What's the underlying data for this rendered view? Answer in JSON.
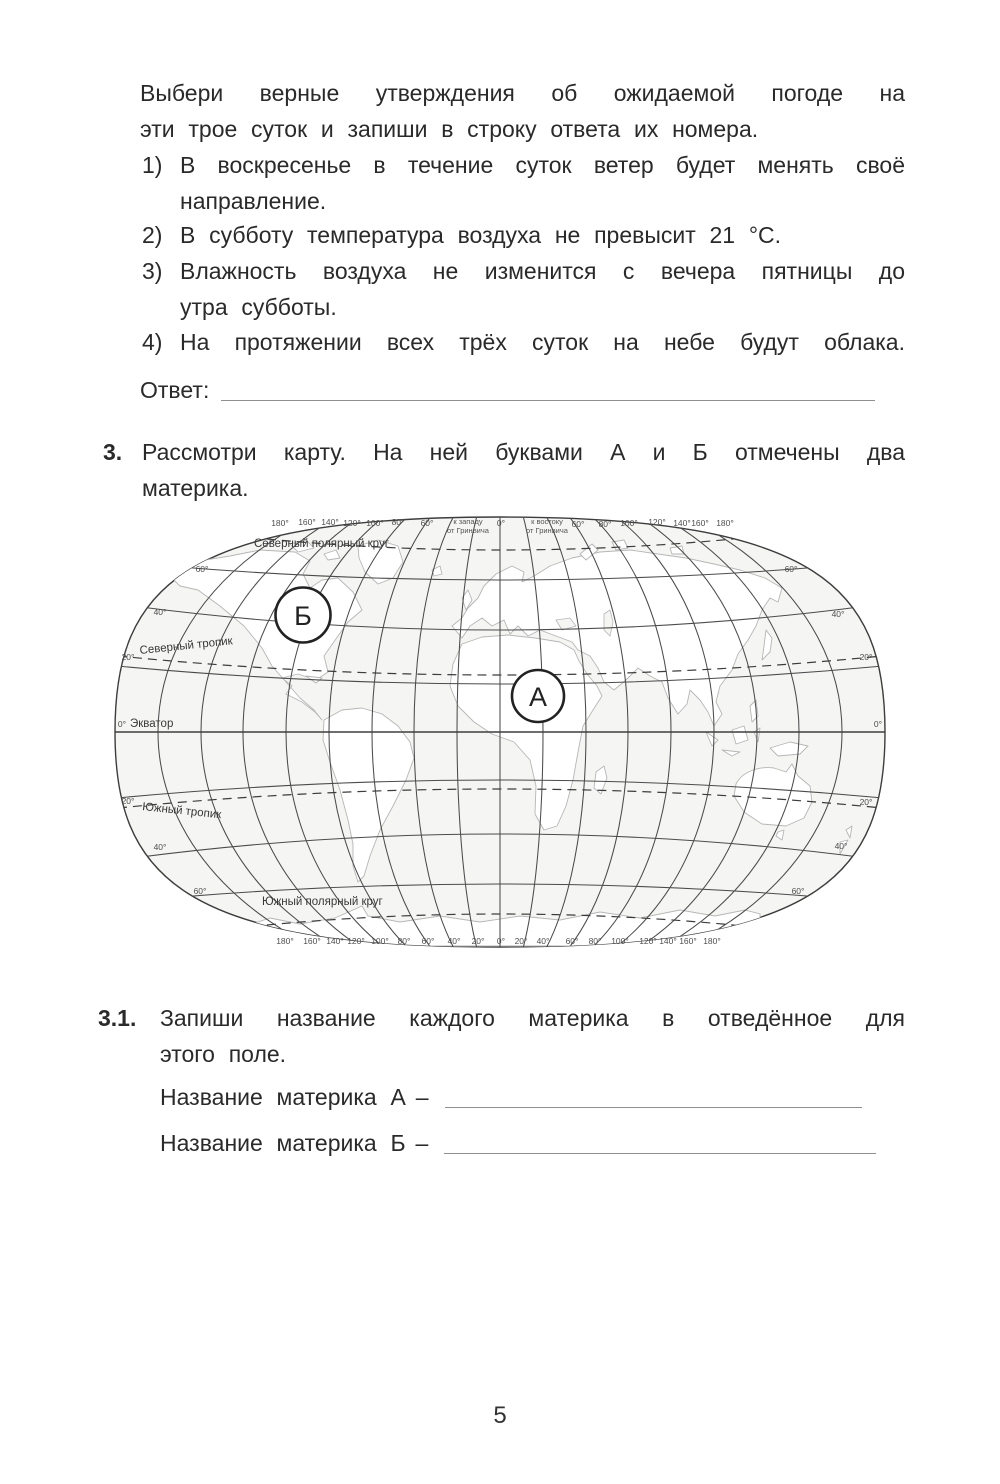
{
  "task2": {
    "intro_l1": "Выбери верные утверждения об ожидаемой погоде на",
    "intro_l2": "эти трое суток и запиши в строку ответа их номера.",
    "items": [
      {
        "num": "1)",
        "l1": "В воскресенье в течение суток ветер будет менять своё",
        "l2": "направление."
      },
      {
        "num": "2)",
        "l1": "В субботу температура воздуха не превысит 21 °С.",
        "l2": ""
      },
      {
        "num": "3)",
        "l1": "Влажность воздуха не изменится с вечера пятницы до",
        "l2": "утра субботы."
      },
      {
        "num": "4)",
        "l1": "На протяжении всех трёх суток на небе будут облака.",
        "l2": ""
      }
    ],
    "answer_label": "Ответ:"
  },
  "task3": {
    "num": "3.",
    "l1": "Рассмотри карту. На ней буквами А и Б отмечены два",
    "l2": "материка."
  },
  "map": {
    "top_left": [
      "180°",
      "160°",
      "140°",
      "120°",
      "100°",
      "80°",
      "60°"
    ],
    "west_note_1": "к западу",
    "west_note_2": "от Гринвича",
    "zero_top": "0°",
    "east_note_1": "к востоку",
    "east_note_2": "от Гринвича",
    "top_right": [
      "60°",
      "80°",
      "100°",
      "120°",
      "140°",
      "160°",
      "180°"
    ],
    "bottom": [
      "180°",
      "160°",
      "140°",
      "120°",
      "100°",
      "80°",
      "60°",
      "40°",
      "20°",
      "0°",
      "20°",
      "40°",
      "60°",
      "80°",
      "100°",
      "120°",
      "140°",
      "160°",
      "180°"
    ],
    "lat_left": [
      "60°",
      "40°",
      "20°",
      "0°",
      "20°",
      "40°",
      "60°"
    ],
    "lat_right": [
      "60°",
      "40°",
      "20°",
      "0°",
      "20°",
      "40°",
      "60°"
    ],
    "n_polar": "Северный полярный круг",
    "n_tropic": "Северный тропик",
    "equator": "Экватор",
    "s_tropic": "Южный тропик",
    "s_polar": "Южный полярный круг",
    "marker_a": "А",
    "marker_b": "Б"
  },
  "task3_1": {
    "num": "3.1.",
    "l1": "Запиши название каждого материка в отведённое для",
    "l2": "этого поле.",
    "field_a": "Название материка А",
    "field_b": "Название материка Б",
    "dash": "–"
  },
  "page": {
    "number": "5"
  }
}
